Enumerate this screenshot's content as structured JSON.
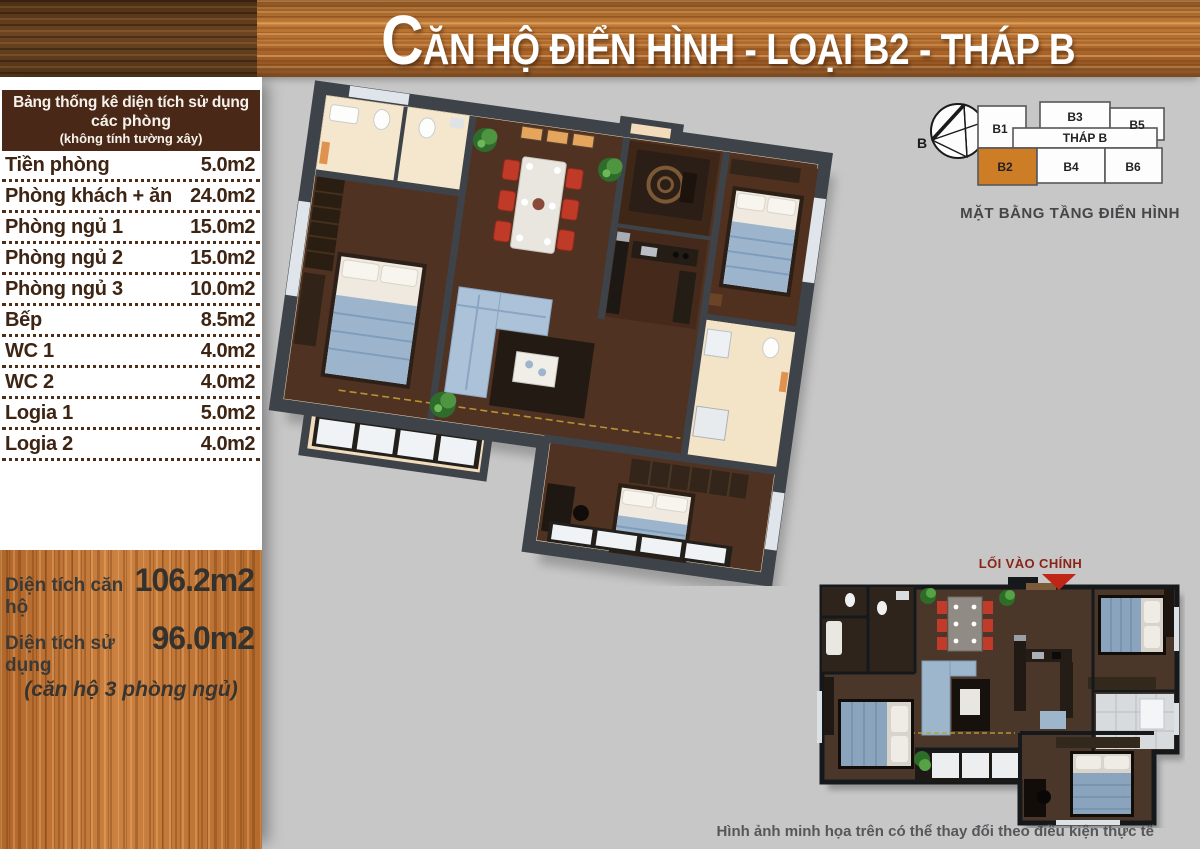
{
  "header": {
    "title_initial": "C",
    "title_rest": "ĂN HỘ ĐIỂN HÌNH - LOẠI B2 - THÁP B"
  },
  "area_table": {
    "title_line1": "Bảng thống kê diện tích sử dụng",
    "title_line2": "các phòng",
    "title_line3": "(không tính tường xây)",
    "rows": [
      {
        "label": "Tiền phòng",
        "value": "5.0m2"
      },
      {
        "label": "Phòng khách + ăn",
        "value": "24.0m2"
      },
      {
        "label": "Phòng ngủ 1",
        "value": "15.0m2"
      },
      {
        "label": "Phòng ngủ 2",
        "value": "15.0m2"
      },
      {
        "label": "Phòng ngủ 3",
        "value": "10.0m2"
      },
      {
        "label": "Bếp",
        "value": "8.5m2"
      },
      {
        "label": "WC 1",
        "value": "4.0m2"
      },
      {
        "label": "WC 2",
        "value": "4.0m2"
      },
      {
        "label": "Logia 1",
        "value": "5.0m2"
      },
      {
        "label": "Logia 2",
        "value": "4.0m2"
      }
    ]
  },
  "summary": {
    "total_label": "Diện tích căn hộ",
    "total_value": "106.2m2",
    "usable_label": "Diện tích sử dụng",
    "usable_value": "96.0m2",
    "note": "(căn hộ 3 phòng ngủ)"
  },
  "floor_diagram": {
    "compass_label": "B",
    "tower_label": "THÁP B",
    "units": {
      "b1": "B1",
      "b2": "B2",
      "b3": "B3",
      "b4": "B4",
      "b5": "B5",
      "b6": "B6"
    },
    "highlighted_unit": "B2",
    "highlight_color": "#ce7d27",
    "caption": "MẶT BẰNG TẦNG ĐIỂN HÌNH"
  },
  "plan_2d": {
    "entrance_label": "LỐI VÀO CHÍNH"
  },
  "footer": {
    "disclaimer": "Hình ảnh minh họa trên có thể thay đổi theo điều kiện thực tế"
  },
  "colors": {
    "background": "#c7c7c7",
    "table_header_bg": "#4a2817",
    "table_text": "#3e2413",
    "banner_wood": "#ad6729",
    "summary_wood": "#c0722f",
    "entrance_text": "#8a2418",
    "arrow_red": "#bf2617"
  }
}
